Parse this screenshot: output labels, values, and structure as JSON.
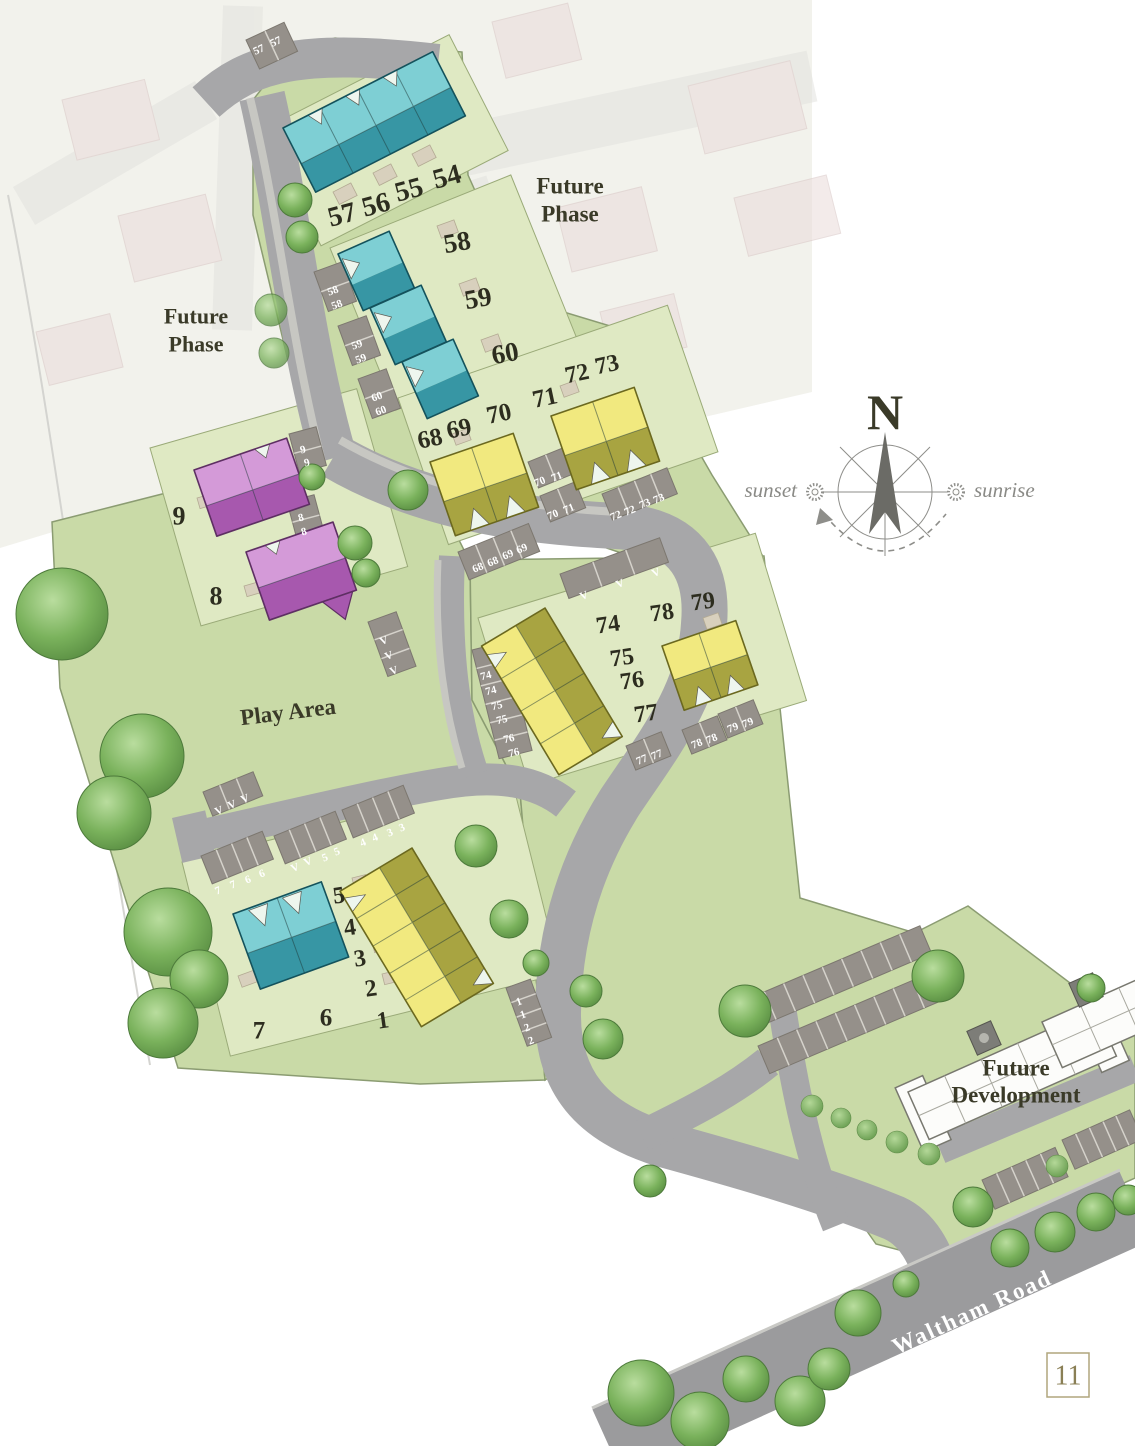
{
  "page": {
    "number": "11"
  },
  "labels": {
    "future_phase": {
      "line1": "Future",
      "line2": "Phase"
    },
    "future_development": {
      "line1": "Future",
      "line2": "Development"
    },
    "play_area": "Play Area",
    "road_name": "Waltham Road"
  },
  "compass": {
    "north": "N",
    "west_label": "sunset",
    "east_label": "sunrise"
  },
  "legend_colors": {
    "teal_homes": "#7ecfd4",
    "yellow_homes": "#f1e97f",
    "purple_homes": "#d49ad8",
    "site_green": "#c9daa7",
    "road_gray": "#a7a7a9"
  },
  "plot_labels": [
    {
      "t": "54",
      "x": 447,
      "y": 177,
      "r": -15,
      "s": 28
    },
    {
      "t": "55",
      "x": 409,
      "y": 190,
      "r": -15,
      "s": 28
    },
    {
      "t": "56",
      "x": 376,
      "y": 205,
      "r": -15,
      "s": 28
    },
    {
      "t": "57",
      "x": 342,
      "y": 215,
      "r": -15,
      "s": 28
    },
    {
      "t": "58",
      "x": 457,
      "y": 242,
      "r": -10,
      "s": 27
    },
    {
      "t": "59",
      "x": 478,
      "y": 298,
      "r": -10,
      "s": 27
    },
    {
      "t": "60",
      "x": 505,
      "y": 353,
      "r": -10,
      "s": 27
    },
    {
      "t": "68",
      "x": 430,
      "y": 439,
      "r": -12,
      "s": 25
    },
    {
      "t": "69",
      "x": 459,
      "y": 429,
      "r": -12,
      "s": 25
    },
    {
      "t": "70",
      "x": 499,
      "y": 414,
      "r": -12,
      "s": 25
    },
    {
      "t": "71",
      "x": 545,
      "y": 398,
      "r": -12,
      "s": 25
    },
    {
      "t": "72",
      "x": 577,
      "y": 374,
      "r": -12,
      "s": 24
    },
    {
      "t": "73",
      "x": 607,
      "y": 365,
      "r": -12,
      "s": 24
    },
    {
      "t": "74",
      "x": 608,
      "y": 625,
      "r": -8,
      "s": 24
    },
    {
      "t": "75",
      "x": 622,
      "y": 658,
      "r": -8,
      "s": 24
    },
    {
      "t": "76",
      "x": 632,
      "y": 681,
      "r": -8,
      "s": 24
    },
    {
      "t": "77",
      "x": 646,
      "y": 714,
      "r": -8,
      "s": 24
    },
    {
      "t": "78",
      "x": 662,
      "y": 613,
      "r": -8,
      "s": 24
    },
    {
      "t": "79",
      "x": 703,
      "y": 602,
      "r": -8,
      "s": 24
    },
    {
      "t": "9",
      "x": 179,
      "y": 516,
      "r": 0,
      "s": 26
    },
    {
      "t": "8",
      "x": 216,
      "y": 596,
      "r": 0,
      "s": 26
    },
    {
      "t": "5",
      "x": 339,
      "y": 896,
      "r": -8,
      "s": 24
    },
    {
      "t": "4",
      "x": 350,
      "y": 928,
      "r": -8,
      "s": 24
    },
    {
      "t": "3",
      "x": 360,
      "y": 959,
      "r": -8,
      "s": 24
    },
    {
      "t": "2",
      "x": 371,
      "y": 989,
      "r": -8,
      "s": 24
    },
    {
      "t": "1",
      "x": 383,
      "y": 1021,
      "r": -8,
      "s": 24
    },
    {
      "t": "6",
      "x": 326,
      "y": 1018,
      "r": 0,
      "s": 25
    },
    {
      "t": "7",
      "x": 259,
      "y": 1031,
      "r": 0,
      "s": 25
    }
  ],
  "parking_labels": [
    {
      "t": "57",
      "x": 259,
      "y": 50,
      "r": -25
    },
    {
      "t": "57",
      "x": 276,
      "y": 42,
      "r": -25
    },
    {
      "t": "58",
      "x": 333,
      "y": 291,
      "r": -20
    },
    {
      "t": "58",
      "x": 337,
      "y": 305,
      "r": -20
    },
    {
      "t": "59",
      "x": 357,
      "y": 345,
      "r": -20
    },
    {
      "t": "59",
      "x": 361,
      "y": 359,
      "r": -20
    },
    {
      "t": "60",
      "x": 377,
      "y": 397,
      "r": -20
    },
    {
      "t": "60",
      "x": 381,
      "y": 411,
      "r": -20
    },
    {
      "t": "9",
      "x": 303,
      "y": 450,
      "r": -15
    },
    {
      "t": "9",
      "x": 307,
      "y": 463,
      "r": -15
    },
    {
      "t": "8",
      "x": 301,
      "y": 518,
      "r": -15
    },
    {
      "t": "8",
      "x": 304,
      "y": 532,
      "r": -15
    },
    {
      "t": "V",
      "x": 384,
      "y": 641,
      "r": -20
    },
    {
      "t": "V",
      "x": 389,
      "y": 656,
      "r": -20
    },
    {
      "t": "V",
      "x": 394,
      "y": 671,
      "r": -20
    },
    {
      "t": "68",
      "x": 478,
      "y": 568,
      "r": -22
    },
    {
      "t": "68",
      "x": 493,
      "y": 562,
      "r": -22
    },
    {
      "t": "69",
      "x": 508,
      "y": 555,
      "r": -22
    },
    {
      "t": "69",
      "x": 522,
      "y": 549,
      "r": -22
    },
    {
      "t": "70",
      "x": 540,
      "y": 482,
      "r": -22
    },
    {
      "t": "71",
      "x": 557,
      "y": 477,
      "r": -22
    },
    {
      "t": "70",
      "x": 553,
      "y": 515,
      "r": -22
    },
    {
      "t": "71",
      "x": 569,
      "y": 509,
      "r": -22
    },
    {
      "t": "72",
      "x": 616,
      "y": 516,
      "r": -22
    },
    {
      "t": "72",
      "x": 630,
      "y": 511,
      "r": -22
    },
    {
      "t": "73",
      "x": 645,
      "y": 504,
      "r": -22
    },
    {
      "t": "73",
      "x": 659,
      "y": 499,
      "r": -22
    },
    {
      "t": "V",
      "x": 584,
      "y": 596,
      "r": -22
    },
    {
      "t": "V",
      "x": 620,
      "y": 584,
      "r": -22
    },
    {
      "t": "V",
      "x": 656,
      "y": 573,
      "r": -22
    },
    {
      "t": "74",
      "x": 486,
      "y": 676,
      "r": -14
    },
    {
      "t": "74",
      "x": 491,
      "y": 691,
      "r": -14
    },
    {
      "t": "75",
      "x": 497,
      "y": 706,
      "r": -14
    },
    {
      "t": "75",
      "x": 502,
      "y": 720,
      "r": -14
    },
    {
      "t": "76",
      "x": 509,
      "y": 739,
      "r": -14
    },
    {
      "t": "76",
      "x": 514,
      "y": 753,
      "r": -14
    },
    {
      "t": "77",
      "x": 642,
      "y": 760,
      "r": -22
    },
    {
      "t": "77",
      "x": 657,
      "y": 755,
      "r": -22
    },
    {
      "t": "78",
      "x": 697,
      "y": 744,
      "r": -22
    },
    {
      "t": "78",
      "x": 712,
      "y": 739,
      "r": -22
    },
    {
      "t": "79",
      "x": 733,
      "y": 728,
      "r": -22
    },
    {
      "t": "79",
      "x": 748,
      "y": 723,
      "r": -22
    },
    {
      "t": "V",
      "x": 219,
      "y": 811,
      "r": -22
    },
    {
      "t": "V",
      "x": 232,
      "y": 805,
      "r": -22
    },
    {
      "t": "V",
      "x": 245,
      "y": 799,
      "r": -22
    },
    {
      "t": "7",
      "x": 218,
      "y": 891,
      "r": -22
    },
    {
      "t": "7",
      "x": 233,
      "y": 885,
      "r": -22
    },
    {
      "t": "6",
      "x": 248,
      "y": 880,
      "r": -22
    },
    {
      "t": "6",
      "x": 262,
      "y": 874,
      "r": -22
    },
    {
      "t": "V",
      "x": 295,
      "y": 868,
      "r": -22
    },
    {
      "t": "V",
      "x": 308,
      "y": 862,
      "r": -22
    },
    {
      "t": "5",
      "x": 325,
      "y": 858,
      "r": -22
    },
    {
      "t": "5",
      "x": 337,
      "y": 852,
      "r": -22
    },
    {
      "t": "4",
      "x": 363,
      "y": 843,
      "r": -22
    },
    {
      "t": "4",
      "x": 375,
      "y": 838,
      "r": -22
    },
    {
      "t": "3",
      "x": 390,
      "y": 833,
      "r": -22
    },
    {
      "t": "3",
      "x": 402,
      "y": 828,
      "r": -22
    },
    {
      "t": "1",
      "x": 519,
      "y": 1002,
      "r": -20
    },
    {
      "t": "1",
      "x": 523,
      "y": 1015,
      "r": -20
    },
    {
      "t": "2",
      "x": 527,
      "y": 1028,
      "r": -20
    },
    {
      "t": "2",
      "x": 531,
      "y": 1041,
      "r": -20
    }
  ]
}
